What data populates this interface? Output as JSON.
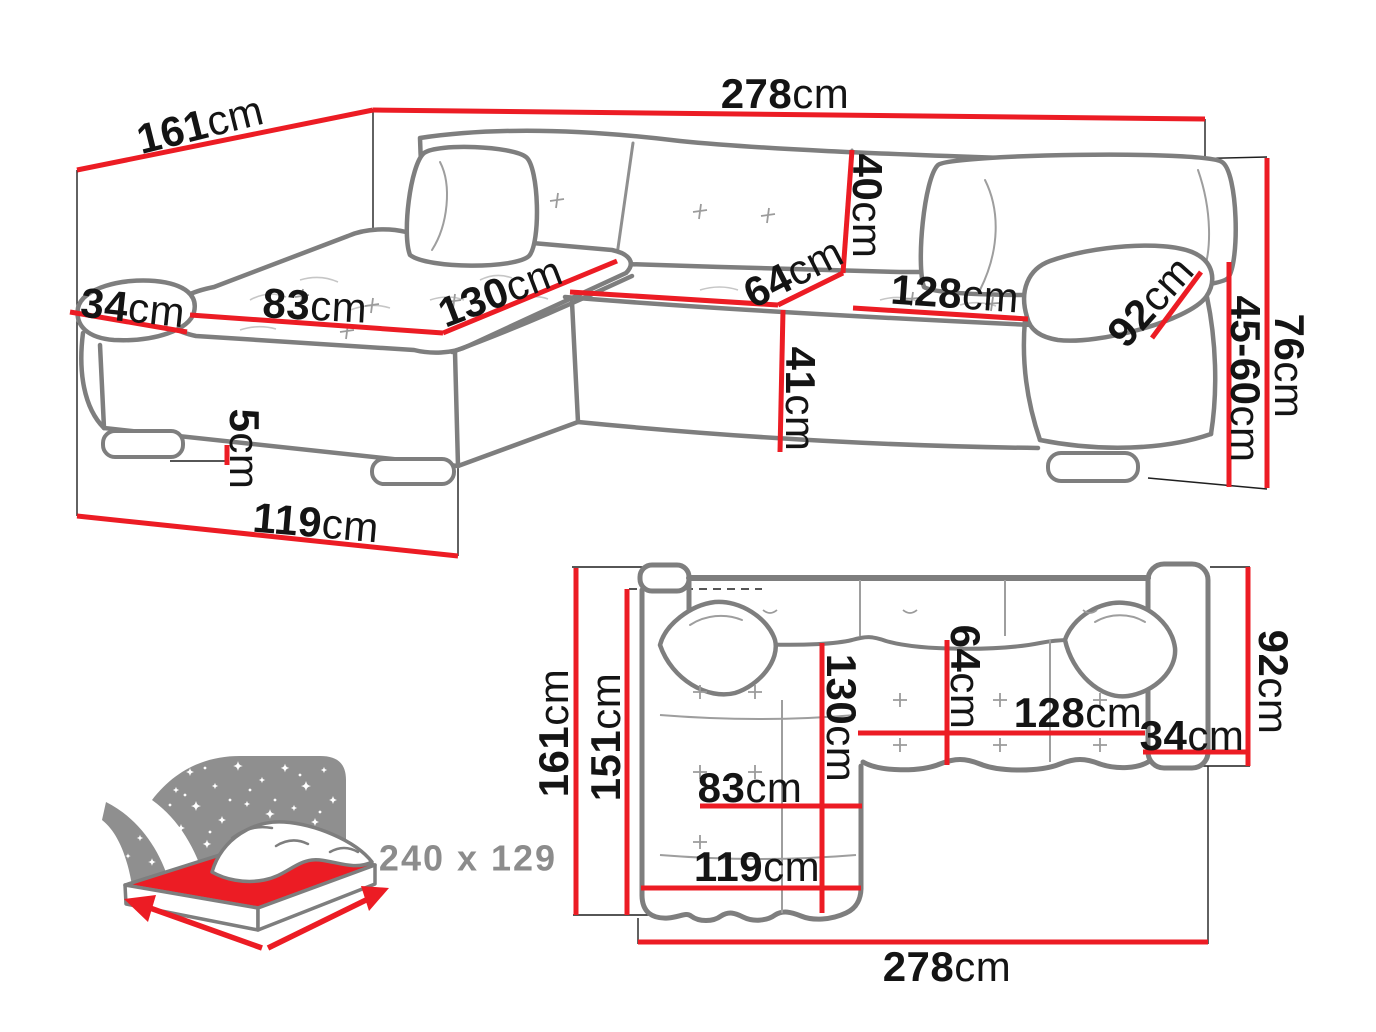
{
  "diagram_type": "corner-sofa dimension drawing",
  "colors": {
    "dimension_red": "#ec1c24",
    "outline_gray": "#7e7e7e",
    "guide_black": "#1f1f1f",
    "text_black": "#141414",
    "muted_gray": "#8c8c8c"
  },
  "perspective_view": {
    "description": "corner sofa 3/4 perspective with dimension lines",
    "dims": {
      "width_total": {
        "value": "278",
        "unit": "cm"
      },
      "depth_total": {
        "value": "161",
        "unit": "cm"
      },
      "armrest_left": {
        "value": "34",
        "unit": "cm"
      },
      "chaise_seat_width": {
        "value": "83",
        "unit": "cm"
      },
      "chaise_length": {
        "value": "130",
        "unit": "cm"
      },
      "seat_depth": {
        "value": "64",
        "unit": "cm"
      },
      "backrest_height": {
        "value": "40",
        "unit": "cm"
      },
      "seat_width": {
        "value": "128",
        "unit": "cm"
      },
      "armrest_length": {
        "value": "92",
        "unit": "cm"
      },
      "total_height": {
        "value": "76",
        "unit": "cm"
      },
      "seat_height_range": {
        "value": "45-60",
        "unit": "cm"
      },
      "seat_height": {
        "value": "41",
        "unit": "cm"
      },
      "leg_height": {
        "value": "5",
        "unit": "cm"
      },
      "chaise_front": {
        "value": "119",
        "unit": "cm"
      }
    }
  },
  "plan_view": {
    "description": "top-down plan of corner sofa with dimension lines",
    "dims": {
      "depth_total": {
        "value": "161",
        "unit": "cm"
      },
      "depth_inner": {
        "value": "151",
        "unit": "cm"
      },
      "armrest_depth": {
        "value": "92",
        "unit": "cm"
      },
      "seat_depth": {
        "value": "64",
        "unit": "cm"
      },
      "chaise_length": {
        "value": "130",
        "unit": "cm"
      },
      "seat_width": {
        "value": "128",
        "unit": "cm"
      },
      "armrest_width": {
        "value": "34",
        "unit": "cm"
      },
      "chaise_seat_width": {
        "value": "83",
        "unit": "cm"
      },
      "chaise_front": {
        "value": "119",
        "unit": "cm"
      },
      "width_total": {
        "value": "278",
        "unit": "cm"
      }
    }
  },
  "bed_icon": {
    "meaning": "sleeping surface size",
    "size_label": "240 x 129"
  }
}
